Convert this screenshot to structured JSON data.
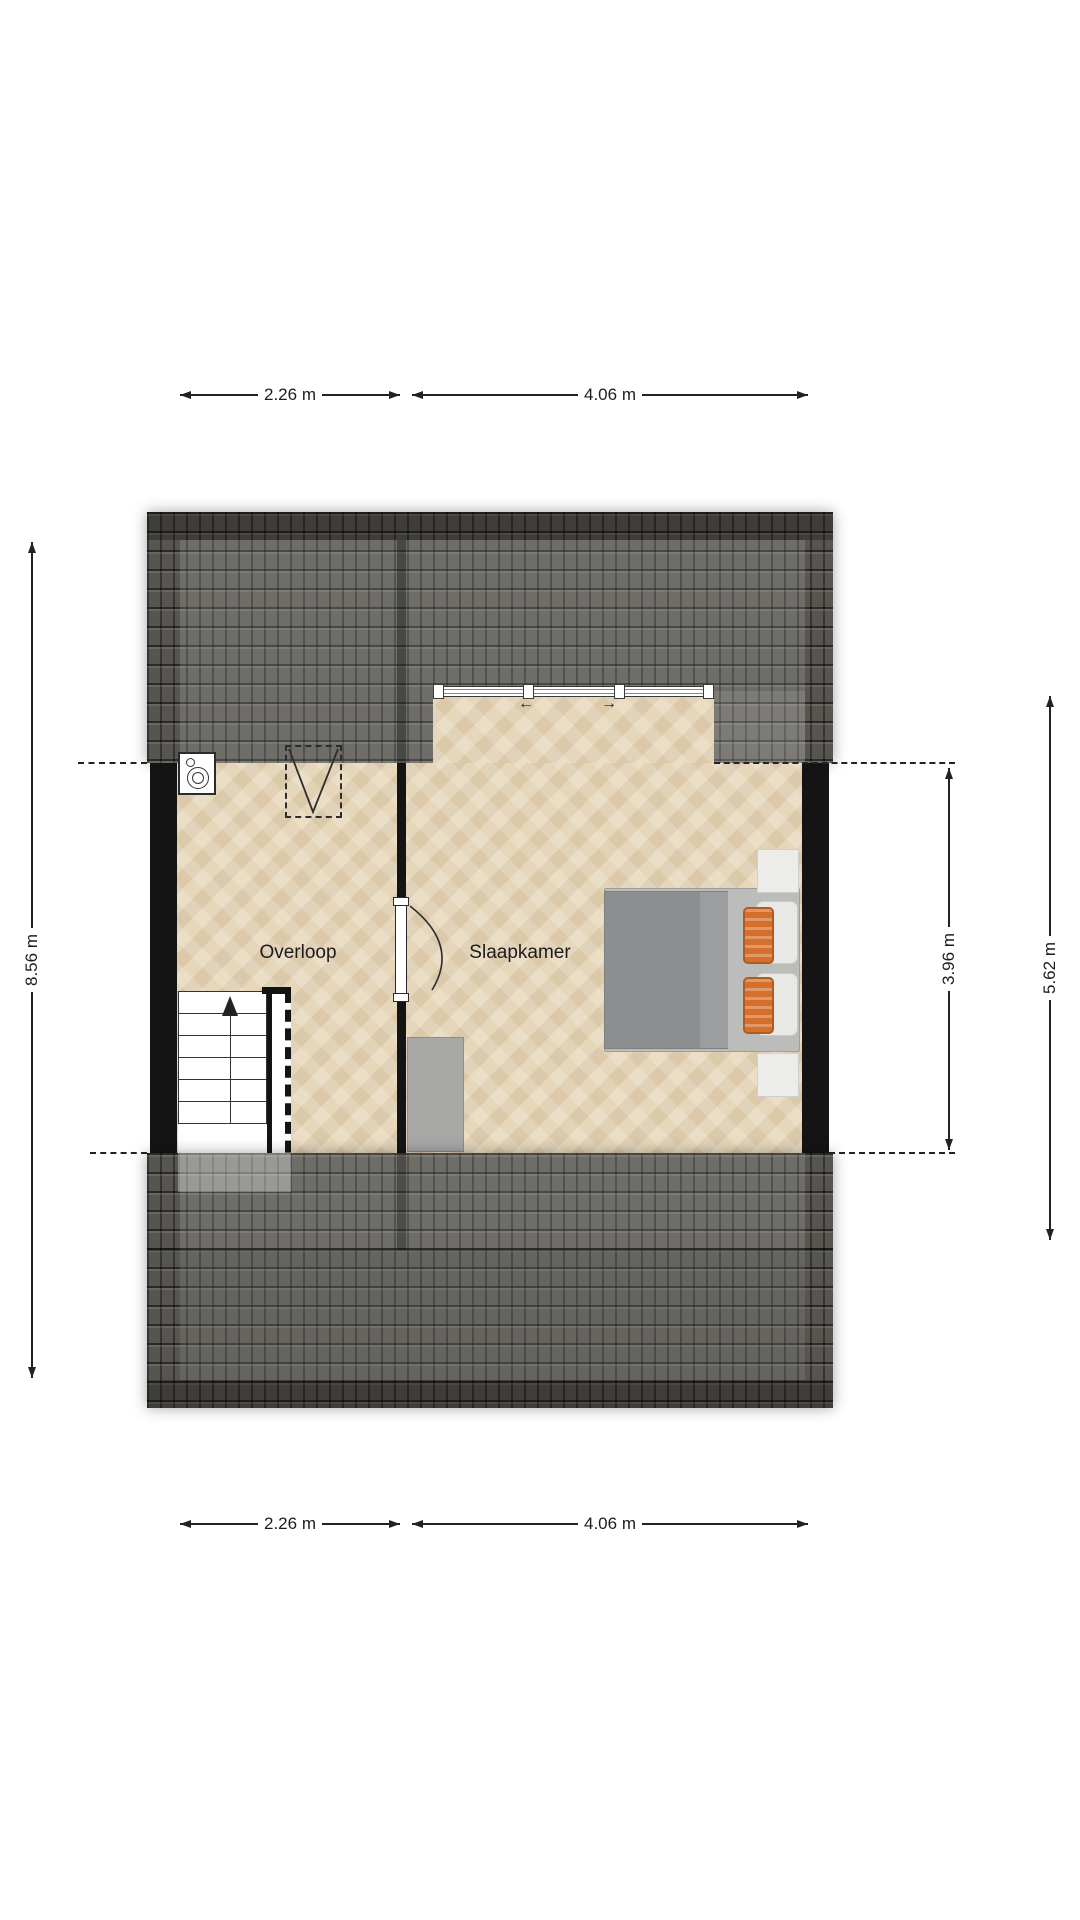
{
  "rooms": {
    "overloop": {
      "label": "Overloop"
    },
    "slaapkamer": {
      "label": "Slaapkamer"
    }
  },
  "dimensions": {
    "top": [
      {
        "label": "2.26 m"
      },
      {
        "label": "4.06 m"
      }
    ],
    "bottom": [
      {
        "label": "2.26 m"
      },
      {
        "label": "4.06 m"
      }
    ],
    "left": [
      {
        "label": "8.56 m"
      }
    ],
    "right": [
      {
        "label": "3.96 m"
      },
      {
        "label": "5.62 m"
      }
    ]
  },
  "window": {
    "slide_arrows": {
      "left": "←",
      "right": "→"
    }
  },
  "icons": {
    "stairs_direction": "up-arrow",
    "door": "quarter-arc-swing",
    "roof_hatch": "dashed-rect-with-v",
    "boiler": "double-circle-unit"
  },
  "colors": {
    "roof_base": "#57554f",
    "floor": "#e7d7ba",
    "wall": "#141414",
    "dimension_line": "#222222",
    "bed_duvet": "#8d8e8f",
    "bed_frame": "#bcbcbb",
    "pillow_white": "#e8e8e6",
    "cushion_orange": "#d4702b",
    "furniture_gray": "#a8a8a7",
    "background": "#ffffff"
  }
}
